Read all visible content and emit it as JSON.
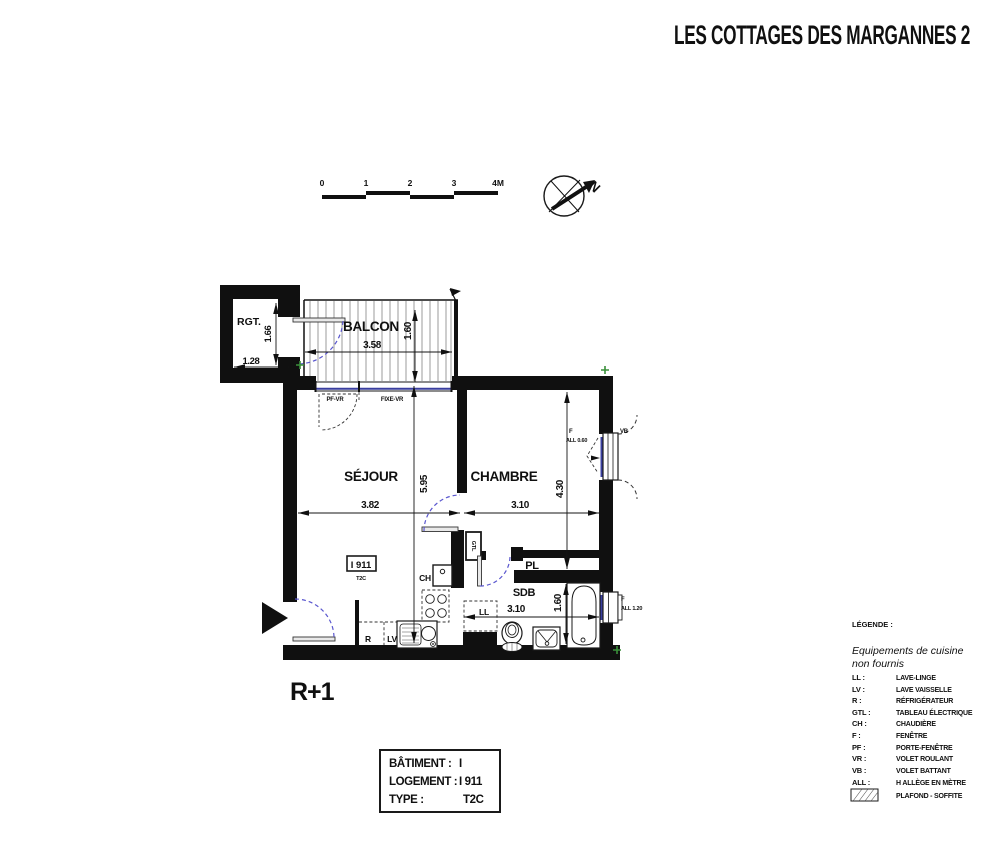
{
  "title": "LES COTTAGES DES MARGANNES 2",
  "scale_bar": {
    "t0": "0",
    "t1": "1",
    "t2": "2",
    "t3": "3",
    "t4": "4M"
  },
  "compass": {
    "north": "N"
  },
  "plan": {
    "floor_label": "R+1",
    "rgt": {
      "name": "RGT.",
      "width": "1.28",
      "height": "1.66"
    },
    "balcon": {
      "name": "BALCON",
      "width": "3.58",
      "depth": "1.60",
      "door_label": "PF-VR",
      "fixed_label": "FIXE-VR"
    },
    "sejour": {
      "name": "SÉJOUR",
      "width": "3.82",
      "height": "5.95"
    },
    "chambre": {
      "name": "CHAMBRE",
      "width": "3.10",
      "height": "4.30",
      "window_type": "F",
      "window_sill": "ALL 0.60",
      "shutter": "VB"
    },
    "sdb": {
      "name": "SDB",
      "width": "3.10",
      "height": "1.60",
      "window_type": "F",
      "window_sill": "ALL 1.20"
    },
    "pl_label": "PL",
    "gtl_label": "GTL",
    "ch_label": "CH",
    "ll_label": "LL",
    "r_label": "R",
    "lv_label": "LV",
    "unit_tag": {
      "id": "I 911",
      "type": "T2C"
    }
  },
  "info_table": {
    "row1_label": "BÂTIMENT :",
    "row1_value": "I",
    "row2_label": "LOGEMENT :",
    "row2_value": "I 911",
    "row3_label": "TYPE :",
    "row3_value": "T2C"
  },
  "legend": {
    "title": "LÉGENDE :",
    "note1": "Equipements de cuisine",
    "note2": "non fournis",
    "items": [
      {
        "k": "LL :",
        "v": "LAVE-LINGE"
      },
      {
        "k": "LV :",
        "v": "LAVE VAISSELLE"
      },
      {
        "k": "R :",
        "v": "RÉFRIGÉRATEUR"
      },
      {
        "k": "GTL :",
        "v": "TABLEAU ÉLECTRIQUE"
      },
      {
        "k": "CH :",
        "v": "CHAUDIÈRE"
      },
      {
        "k": "F :",
        "v": "FENÊTRE"
      },
      {
        "k": "PF :",
        "v": "PORTE-FENÊTRE"
      },
      {
        "k": "VR :",
        "v": "VOLET ROULANT"
      },
      {
        "k": "VB :",
        "v": "VOLET BATTANT"
      },
      {
        "k": "ALL :",
        "v": "H ALLÈGE EN MÈTRE"
      }
    ],
    "hatch_label": "PLAFOND - SOFFITE"
  },
  "colors": {
    "ink": "#101010",
    "door_arc_blue": "#5a57cf",
    "glazing_blue": "#3a3f9f",
    "marker_green": "#3a8f3a",
    "leaf_gray": "#e9e9e9"
  }
}
